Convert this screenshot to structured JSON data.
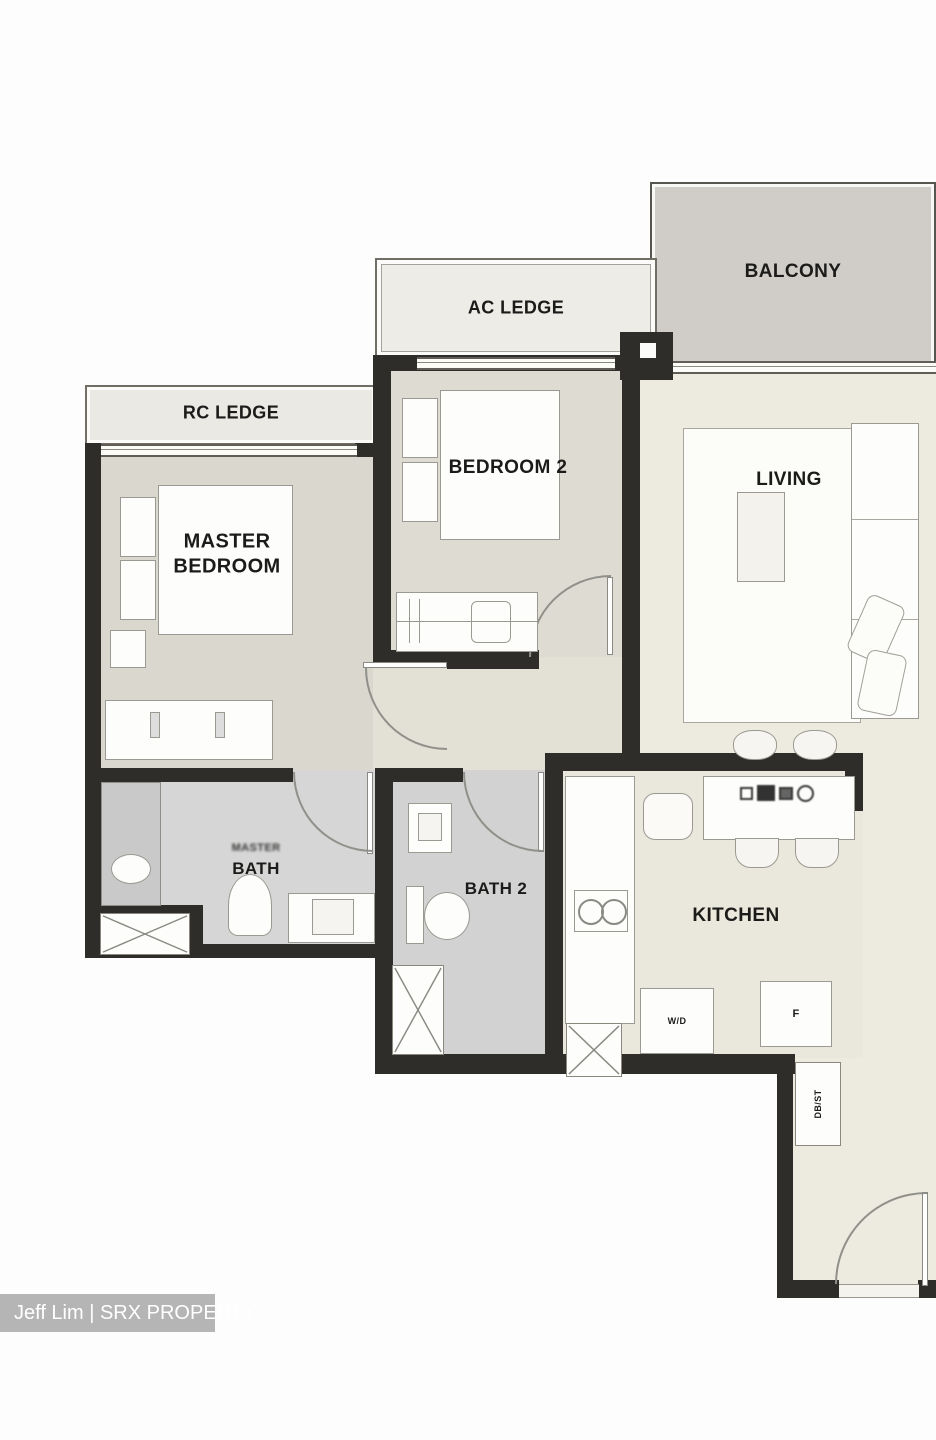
{
  "watermark": {
    "text": "Jeff Lim | SRX PROPERTY"
  },
  "rooms": {
    "balcony": {
      "label": "BALCONY"
    },
    "ac_ledge": {
      "label": "AC LEDGE"
    },
    "rc_ledge": {
      "label": "RC LEDGE"
    },
    "bedroom2": {
      "label": "BEDROOM 2"
    },
    "living": {
      "label": "LIVING"
    },
    "master_bedroom": {
      "line1": "MASTER",
      "line2": "BEDROOM"
    },
    "bath": {
      "label": "BATH",
      "blur_label": "MASTER"
    },
    "bath2": {
      "label": "BATH 2"
    },
    "kitchen": {
      "label": "KITCHEN"
    },
    "wd": {
      "label": "W/D"
    },
    "fridge": {
      "label": "F"
    },
    "dbst": {
      "label": "DB/ST"
    }
  },
  "icons": [
    "shaft-cross-icon",
    "hob-and-sink-icon",
    "double-sink-icon",
    "toilet-icon",
    "basin-icon",
    "door-swing-arc-icon"
  ],
  "colors": {
    "wall": "#2e2d2a",
    "room_beige": "#edebe0",
    "bedroom_beige": "#dad7ce",
    "bath_grey": "#d6d6d6",
    "balcony_grey": "#d0ccc8",
    "ledge_light": "#edece7",
    "watermark_bar": "#b5b5b5",
    "watermark_text": "#ffffff",
    "label_text": "#1b1b19"
  }
}
